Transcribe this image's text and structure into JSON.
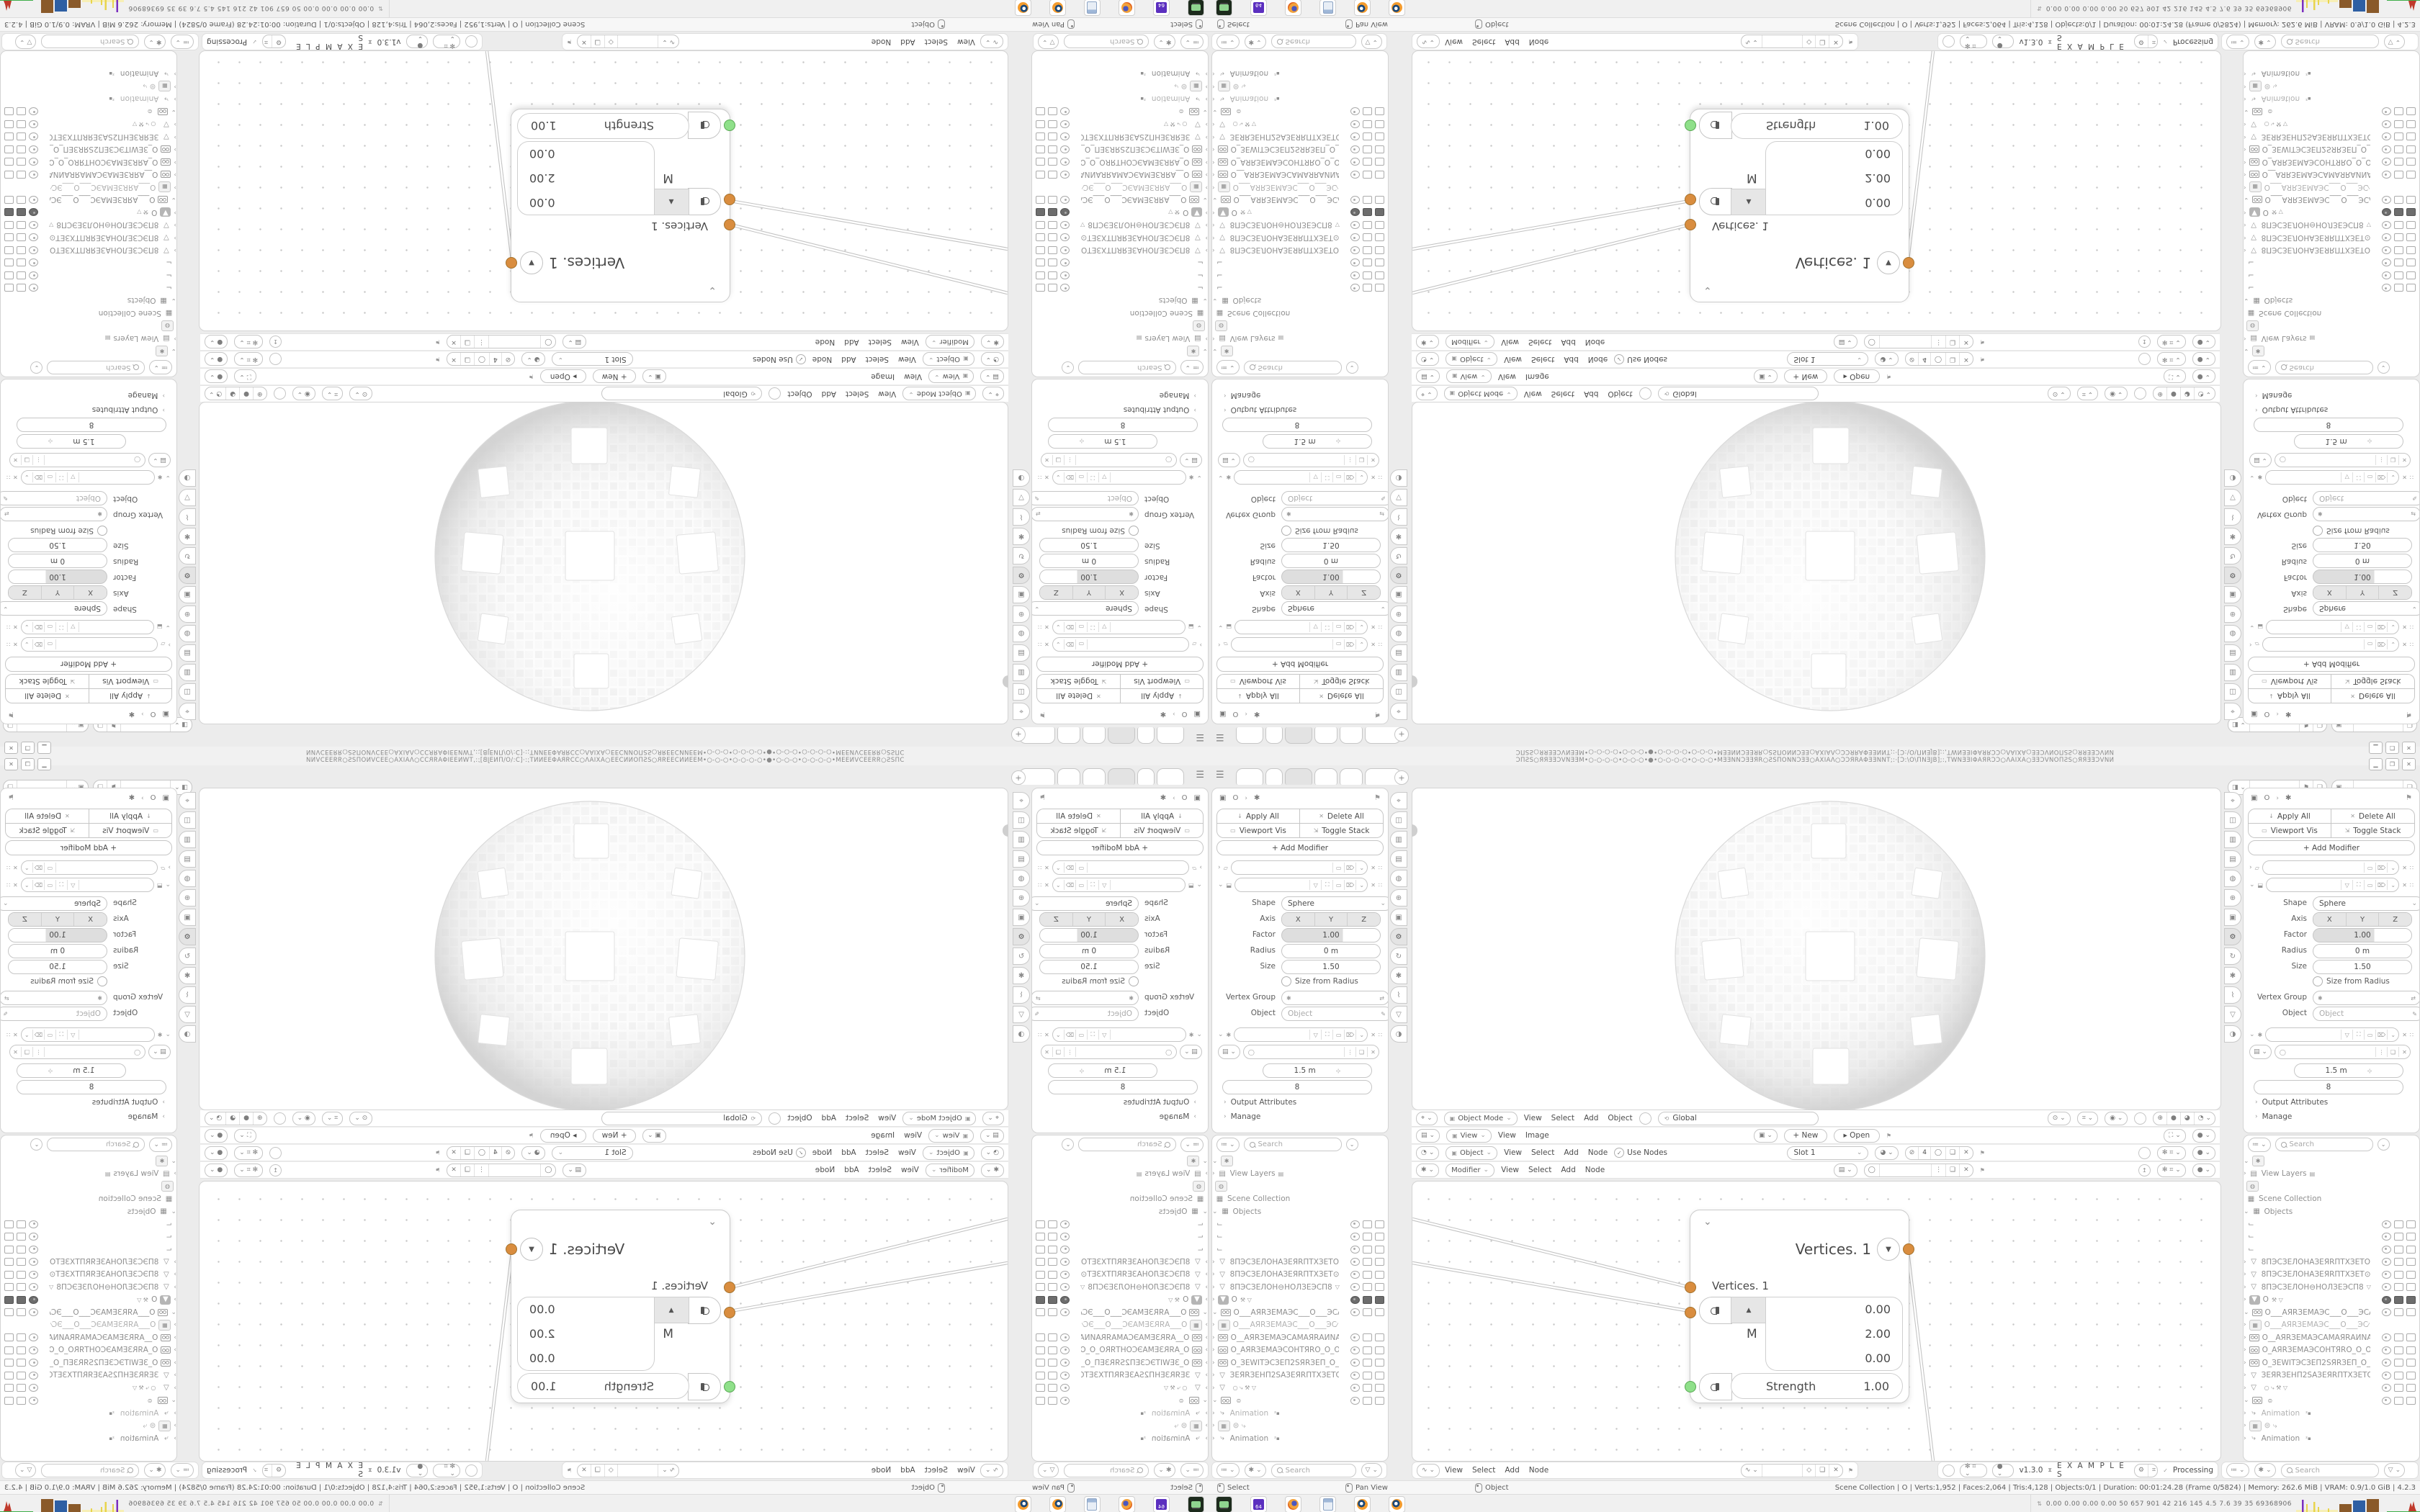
{
  "window": {
    "title_text": "ƆПƧS○ЯЯƎƎƆVNƎƎM•○-○-○-○•○-○-○•●•○-○-○-○•○-○-○•MƎƎNNƆƎƎЯR○ƧSПONNƆƎƎ○AXIAΛ○ƆƆЯRAΦƎƎNNT;:·[Ɔ:\\O\\ПNƎJB];:,TWNƎƎIΦAЯRƆƆ○ΛAIXA○ƎƎƆVNOПƧS○ЯЯƎƎƆVNИ",
    "minimize": "▁",
    "maximize": "❐",
    "close": "✕"
  },
  "topbar": {
    "hamburger": "☰",
    "tabs": [
      {
        "w": 36
      },
      {
        "w": 22
      },
      {
        "w": 36,
        "cls": "active"
      },
      {
        "w": 30
      },
      {
        "w": 30
      },
      {
        "w": 48
      }
    ],
    "new_tab": "+",
    "id_selectors": [
      {
        "icon": "◨",
        "chev": "⌄",
        "buttons": [
          "⚑",
          "❏"
        ]
      },
      {
        "icon": "▣",
        "chev": "⌄",
        "buttons": [
          "❏"
        ]
      }
    ]
  },
  "properties": {
    "breadcrumb": {
      "object_icon": "▣",
      "object": "O",
      "sep": "›",
      "modifier_icon": "✱",
      "pin": "⚑"
    },
    "actions": [
      {
        "icon": "↓",
        "label": "Apply All"
      },
      {
        "icon": "✕",
        "label": "Delete All"
      },
      {
        "icon": "▭",
        "label": "Viewport Vis"
      },
      {
        "icon": "⇲",
        "label": "Toggle Stack"
      }
    ],
    "add_modifier": "+  Add Modifier",
    "mod1_icons": [
      "▭",
      "⌦",
      "⌄"
    ],
    "mod2_icons": [
      "▽",
      "⛶",
      "▭",
      "⌦",
      "⌄"
    ],
    "fields": {
      "shape_label": "Shape",
      "shape_value": "Sphere",
      "axis_label": "Axis",
      "axis_values": [
        "X",
        "Y",
        "Z"
      ],
      "factor_label": "Factor",
      "factor_value": "1.00",
      "radius_label": "Radius",
      "radius_value": "0 m",
      "size_label": "Size",
      "size_value": "1.50",
      "size_from_radius": "Size from Radius",
      "vertex_group_label": "Vertex Group",
      "object_label": "Object",
      "object_placeholder": "Object"
    },
    "geonodes": {
      "icons": [
        "▽",
        "⛶",
        "▭",
        "⌦",
        "⌄"
      ],
      "value1": "1.5 m",
      "value2": "8",
      "links": [
        "Output Attributes",
        "Manage"
      ]
    }
  },
  "outliner": {
    "filter_icon": "≔",
    "search_placeholder": "Search",
    "funnel": "▽",
    "rows": [
      {
        "chev": "⌄",
        "ictype": "glyph-box",
        "ic": "✱",
        "nm": "",
        "t": false
      },
      {
        "chev": "›",
        "ictype": "glyph",
        "ic": "▤",
        "nm": "View Layers",
        "extra": "▤",
        "t": false,
        "cls": "plain"
      },
      {
        "chev": "",
        "ictype": "glyph-box",
        "ic": "◍",
        "nm": "",
        "t": false
      },
      {
        "chev": "",
        "ictype": "glyph",
        "ic": "▦",
        "nm": "Scene Collection",
        "t": false,
        "cls": "plain"
      },
      {
        "chev": "⌄",
        "ictype": "glyph",
        "ic": "▦",
        "nm": "Objects",
        "t": false,
        "cls": "plain"
      },
      {
        "chev": "",
        "ictype": "glyph",
        "ic": "⌙",
        "nm": "",
        "t": true
      },
      {
        "chev": "",
        "ictype": "glyph",
        "ic": "⌙",
        "nm": "",
        "t": true
      },
      {
        "chev": "",
        "ictype": "glyph",
        "ic": "⌙",
        "nm": "",
        "t": true
      },
      {
        "chev": "›",
        "ictype": "glyph",
        "ic": "▽",
        "nm": "8ПЭСЗЕЛОНАЗЕЯRПТХЗЕТОТЗЕХТI",
        "t": true
      },
      {
        "chev": "›",
        "ictype": "glyph",
        "ic": "▽",
        "nm": "8ПЭСЗЕЛОНАЗЕЯRПТХЗЕТ⊙ТЗЕХТI",
        "t": true
      },
      {
        "chev": "›",
        "ictype": "glyph",
        "ic": "▽",
        "nm": "8ПЭСЗЕЛОН⊖НОЛЗЕЭСП8",
        "extra": "▽",
        "t": true
      },
      {
        "chev": "›",
        "ictype": "selbox",
        "ic": "▼",
        "nm": "O",
        "extra": "⚒ ▽",
        "t": true,
        "cls": "sel"
      },
      {
        "chev": "⌄",
        "ictype": "cam",
        "nm": "O___АЯRЗЕМАЭС___O___ЭСАМЗ",
        "t": true
      },
      {
        "chev": "›",
        "ictype": "glyph-box",
        "ic": "▦",
        "nm": "O___АЯRЗЕМАЭС___O___ЭС⁄",
        "t": false,
        "cls": "dim"
      },
      {
        "chev": "›",
        "ictype": "cam",
        "nm": "O__АЯRЗЕМАЭСАМАЯRАИNАП_O",
        "t": true
      },
      {
        "chev": "›",
        "ictype": "cam",
        "nm": "O_АЯRЗЕМАЭСОНТЯRО_O_ОЯRТН",
        "t": true
      },
      {
        "chev": "›",
        "ictype": "cam",
        "nm": "O_ЗЕWITЭСЗЕП2SЯRЗЕП_O_ПЗЕЯF",
        "t": true
      },
      {
        "chev": "›",
        "ictype": "glyph",
        "ic": "▽",
        "nm": "ЗЕЯRЗЕНП2SАЗЕЯRПТХЗЕТОТЗЕХТ",
        "t": true
      },
      {
        "chev": "›",
        "ictype": "glyph",
        "ic": "▽",
        "nm": "",
        "extra": "○  ⤷  ⚒  ▽",
        "t": true
      },
      {
        "chev": "⌄",
        "ictype": "cam",
        "nm": "",
        "extra": "⊜",
        "t": true
      },
      {
        "chev": "›",
        "ictype": "glyph",
        "ic": "⤷",
        "nm": "Animation",
        "badge": "²▪",
        "t": false,
        "cls": "dim"
      },
      {
        "chev": "›",
        "ictype": "glyph-box",
        "ic": "▦",
        "nm": "⊜  ⤷",
        "t": false,
        "cls": "dim"
      },
      {
        "chev": "›",
        "ictype": "glyph",
        "ic": "⤷",
        "nm": "Animation",
        "badge": "²▪",
        "t": false,
        "cls": "plain"
      }
    ]
  },
  "headers": {
    "viewport": {
      "editor_icon": "⌖",
      "mode": "Object Mode",
      "menus": [
        "View",
        "Select",
        "Add",
        "Object"
      ],
      "orientation": "Global",
      "orientation_icon": "⟲"
    },
    "image": {
      "editor_icon": "▤",
      "mode": "View",
      "menus": [
        "View",
        "Image"
      ],
      "new_label": "+  New",
      "open_label": "▸ Open",
      "pin": "⚑"
    },
    "compositor": {
      "editor_icon": "◔",
      "mode": "Object",
      "menus": [
        "View",
        "Select",
        "Add",
        "Node"
      ],
      "use_nodes": "Use Nodes",
      "check": "✓",
      "slot": "Slot 1",
      "count": "4",
      "slot_icons": [
        "◯",
        "❏",
        "✕"
      ],
      "pin": "⚑"
    },
    "geonodes": {
      "editor_icon": "✱",
      "mode": "Modifier",
      "menus": [
        "View",
        "Select",
        "Add",
        "Node"
      ],
      "group_icons": [
        "⋮",
        "❏",
        "✕"
      ],
      "pin": "⚑"
    }
  },
  "node_editor": {
    "node": {
      "collapse_chevron": "⌄",
      "title": "Vertices. 1",
      "dropdown": "▼",
      "output_label": "Vertices. 1",
      "up_arrow": "▲",
      "m_label": "M",
      "vector_values": [
        "0.00",
        "2.00",
        "0.00"
      ],
      "strength_label": "Strength",
      "strength_value": "1.00"
    },
    "socket_color_orange": "#d98d3f",
    "socket_color_green": "#8fe08a"
  },
  "footers": {
    "outliner_left": {
      "icons": [
        "≔",
        "✱"
      ],
      "search": "Search",
      "funnel": "▽"
    },
    "node": {
      "editor_icon": "∿",
      "menus": [
        "View",
        "Select",
        "Add",
        "Node"
      ],
      "sel_icons": [
        "◇",
        "❏",
        "✕"
      ],
      "pin": "⚑"
    },
    "addon": {
      "version": "v1.3.0",
      "hourglass": "⧗",
      "title": "E X A M P L E S",
      "btn_icons": [
        "⚙",
        "⌗"
      ],
      "check": "✓",
      "status": "Processing"
    },
    "outliner_right": {
      "icons": [
        "≔",
        "✱"
      ],
      "search": "Search",
      "funnel": "▽"
    }
  },
  "status_bar": {
    "hints": [
      {
        "label": "Select"
      },
      {
        "label": "Pan View"
      },
      {
        "label": "Object"
      }
    ],
    "stats": "Scene Collection | O | Verts:1,952 | Faces:2,064 | Tris:4,128 | Objects:0/1 | Duration: 00:01:24.28 (Frame 0/5824) | Memory: 262.6 MiB | VRAM: 0.9/1.0 GiB | 4.2.3"
  },
  "taskbar": {
    "apps": [
      {
        "cls": "tb-term",
        "name": "terminal"
      },
      {
        "cls": "tb-floppy",
        "name": "emulator-64"
      },
      {
        "cls": "tb-ffox",
        "name": "firefox"
      },
      {
        "cls": "tb-calc",
        "name": "calculator"
      },
      {
        "cls": "tb-blender",
        "name": "blender"
      },
      {
        "cls": "tb-blender",
        "name": "blender"
      }
    ],
    "sysmon_icon": "⇅",
    "sysmon_numbers": "0.00 0.00 0.00 0.00   50   657   901   42   216   145   4.5   7.6   39   35   69368906",
    "graph_colors": {
      "purple": "#7b2fbe",
      "yellow": "#e8d44d",
      "base_yellow": "#f7efb6",
      "brown": "#8a5a2a",
      "blue": "#2e5fa3",
      "green": "#3fae4a",
      "red": "#c0392b"
    }
  },
  "proptabs": [
    {
      "g": "⌖"
    },
    {
      "g": "◫"
    },
    {
      "g": "▥"
    },
    {
      "g": "▤"
    },
    {
      "g": "◍"
    },
    {
      "g": "⊕"
    },
    {
      "g": "▣"
    },
    {
      "g": "⚙",
      "cls": "sel"
    },
    {
      "g": "↻"
    },
    {
      "g": "✱"
    },
    {
      "g": "⌇"
    },
    {
      "g": "▽"
    },
    {
      "g": "◑"
    }
  ]
}
